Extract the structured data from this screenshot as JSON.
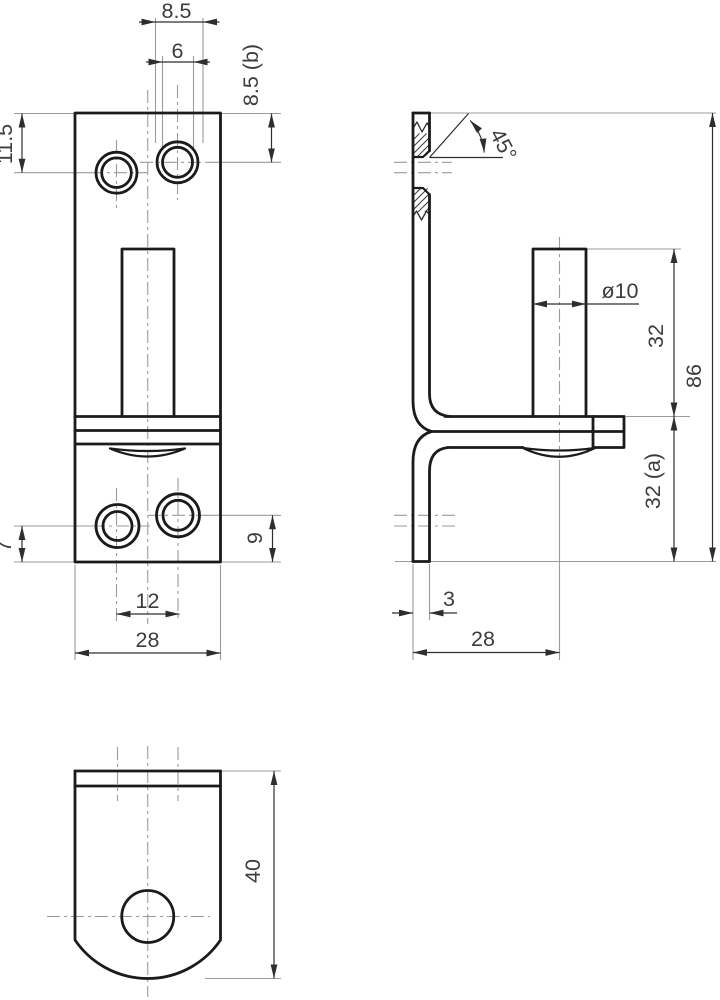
{
  "title": "Technical drawing - pintle bracket, three views",
  "colors": {
    "background": "#ffffff",
    "outline": "#1b1b1b",
    "dimension_line": "#2e2e2e",
    "extension_line": "#9b9b9b",
    "text": "#3c3c3c"
  },
  "views": {
    "front": {
      "dims": {
        "countersink_dia": "8.5",
        "hole_dia": "6",
        "top_right_offset": "8.5 (b)",
        "top_left_offset": "11.5",
        "bottom_left_offset": "7",
        "bottom_right_offset": "9",
        "hole_spacing": "12",
        "width": "28"
      }
    },
    "side": {
      "dims": {
        "chamfer_angle": "45°",
        "pin_dia": "ø10",
        "upper_height": "32",
        "total_height": "86",
        "lower_height": "32 (a)",
        "thickness": "3",
        "pin_offset": "28"
      }
    },
    "bottom": {
      "dims": {
        "flange_length": "40"
      }
    }
  }
}
